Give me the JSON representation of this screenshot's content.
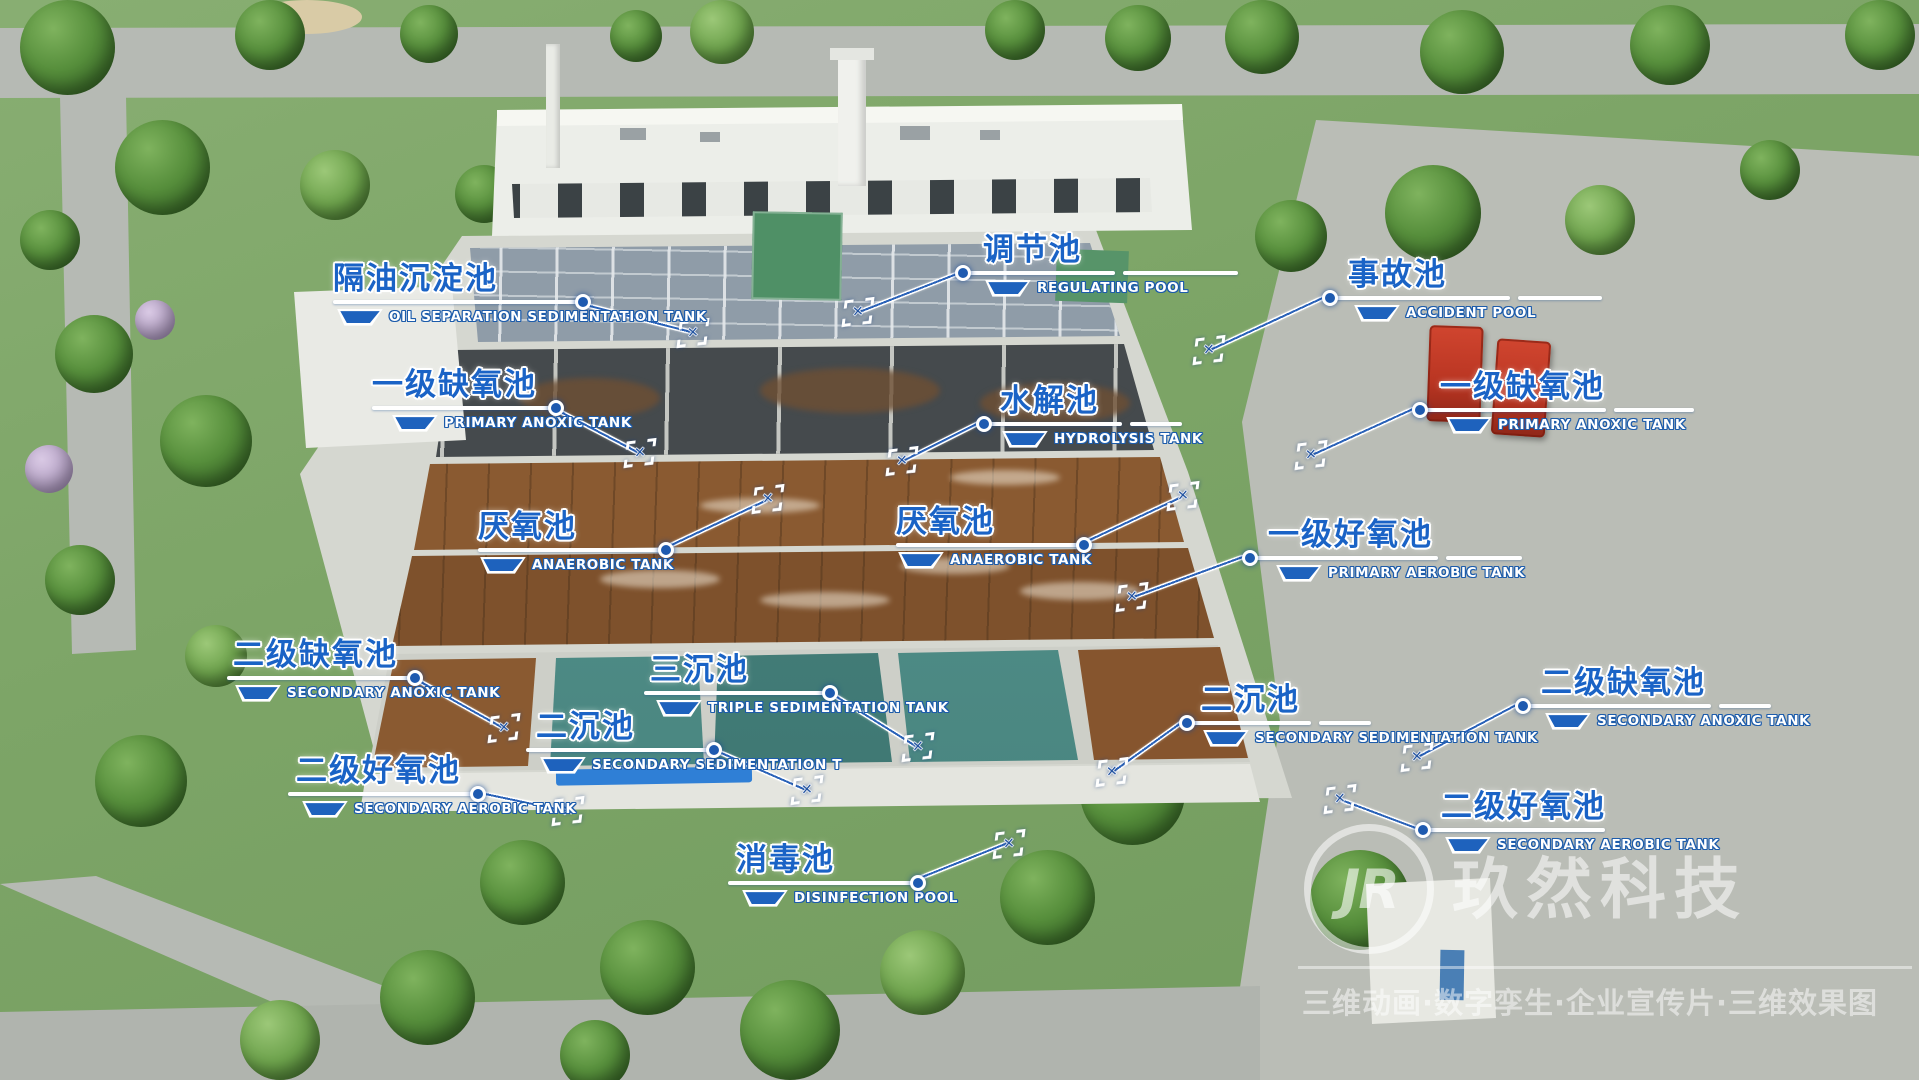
{
  "watermark": {
    "logo_text": "JR",
    "brand": "玖然科技",
    "tagline": "三维动画·数字孪生·企业宣传片·三维效果图"
  },
  "icons": {
    "tank_icon": "blue-trapezoid-tank-shape",
    "marker_glyph": "✕"
  },
  "colors": {
    "label_blue": "#1a63c6",
    "line_white": "#ffffff",
    "marker_blue": "#1d4f9e",
    "pool_teal": "#4d8b85",
    "aeration_brown": "#8a5a31"
  },
  "labels": [
    {
      "id": "oil-separation-sedimentation-tank",
      "cn": "隔油沉淀池",
      "en": "OIL SEPARATION SEDIMENTATION TANK"
    },
    {
      "id": "regulating-pool",
      "cn": "调节池",
      "en": "REGULATING POOL"
    },
    {
      "id": "accident-pool",
      "cn": "事故池",
      "en": "ACCIDENT POOL"
    },
    {
      "id": "primary-anoxic-tank-left",
      "cn": "一级缺氧池",
      "en": "PRIMARY ANOXIC TANK"
    },
    {
      "id": "hydrolysis-tank",
      "cn": "水解池",
      "en": "HYDROLYSIS TANK"
    },
    {
      "id": "primary-anoxic-tank-right",
      "cn": "一级缺氧池",
      "en": "PRIMARY ANOXIC TANK"
    },
    {
      "id": "anaerobic-tank-left",
      "cn": "厌氧池",
      "en": "ANAEROBIC TANK"
    },
    {
      "id": "anaerobic-tank-center",
      "cn": "厌氧池",
      "en": "ANAEROBIC TANK"
    },
    {
      "id": "primary-aerobic-tank",
      "cn": "一级好氧池",
      "en": "PRIMARY AEROBIC TANK"
    },
    {
      "id": "secondary-anoxic-tank-left",
      "cn": "二级缺氧池",
      "en": "SECONDARY ANOXIC TANK"
    },
    {
      "id": "triple-sedimentation-tank",
      "cn": "三沉池",
      "en": "TRIPLE SEDIMENTATION TANK"
    },
    {
      "id": "secondary-sedimentation-tank-left",
      "cn": "二沉池",
      "en": "SECONDARY SEDIMENTATION T"
    },
    {
      "id": "secondary-sedimentation-tank-right",
      "cn": "二沉池",
      "en": "SECONDARY SEDIMENTATION TANK"
    },
    {
      "id": "secondary-anoxic-tank-right",
      "cn": "二级缺氧池",
      "en": "SECONDARY ANOXIC TANK"
    },
    {
      "id": "secondary-aerobic-tank-left",
      "cn": "二级好氧池",
      "en": "SECONDARY AEROBIC TANK"
    },
    {
      "id": "secondary-aerobic-tank-right",
      "cn": "二级好氧池",
      "en": "SECONDARY AEROBIC TANK"
    },
    {
      "id": "disinfection-pool",
      "cn": "消毒池",
      "en": "DISINFECTION POOL"
    }
  ]
}
